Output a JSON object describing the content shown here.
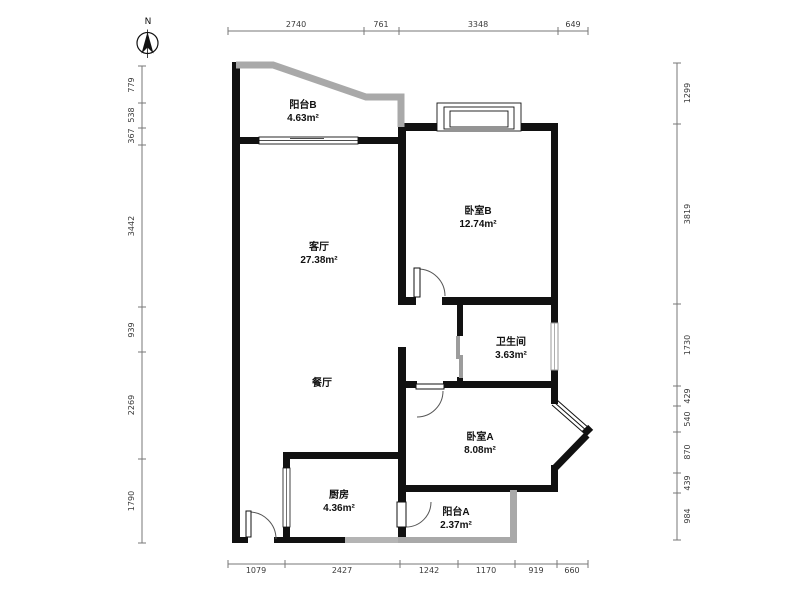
{
  "compass": {
    "label": "N"
  },
  "rooms": [
    {
      "id": "balcony-b",
      "name": "阳台B",
      "area": "4.63m²"
    },
    {
      "id": "living-room",
      "name": "客厅",
      "area": "27.38m²"
    },
    {
      "id": "bedroom-b",
      "name": "卧室B",
      "area": "12.74m²"
    },
    {
      "id": "bathroom",
      "name": "卫生间",
      "area": "3.63m²"
    },
    {
      "id": "dining-room",
      "name": "餐厅",
      "area": ""
    },
    {
      "id": "bedroom-a",
      "name": "卧室A",
      "area": "8.08m²"
    },
    {
      "id": "kitchen",
      "name": "厨房",
      "area": "4.36m²"
    },
    {
      "id": "balcony-a",
      "name": "阳台A",
      "area": "2.37m²"
    }
  ],
  "dimensions": {
    "top": [
      "2740",
      "761",
      "3348",
      "649"
    ],
    "bottom": [
      "1079",
      "2427",
      "1242",
      "1170",
      "919",
      "660"
    ],
    "left": [
      "779",
      "538",
      "367",
      "3442",
      "939",
      "2269",
      "1790"
    ],
    "right": [
      "1299",
      "3819",
      "1730",
      "429",
      "540",
      "870",
      "439",
      "984"
    ]
  },
  "colors": {
    "wall": "#111111",
    "railing": "#a9a9a9",
    "dimension": "#777777"
  }
}
